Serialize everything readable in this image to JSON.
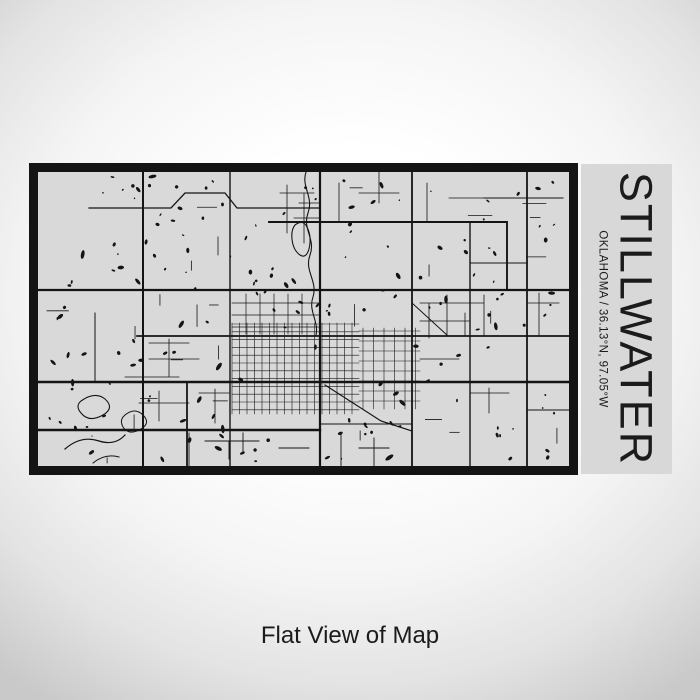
{
  "label": {
    "city": "STILLWATER",
    "subtitle": "OKLAHOMA / 36.13°N, 97.05°W"
  },
  "caption": {
    "text": "Flat View of Map"
  },
  "colors": {
    "ink": "#1b1b1b",
    "map_bg": "#d9d9d9",
    "panel_bg": "#d8d8d8",
    "road": "#141414",
    "bg_center": "#ffffff",
    "bg_edge": "#c9c9c9"
  }
}
